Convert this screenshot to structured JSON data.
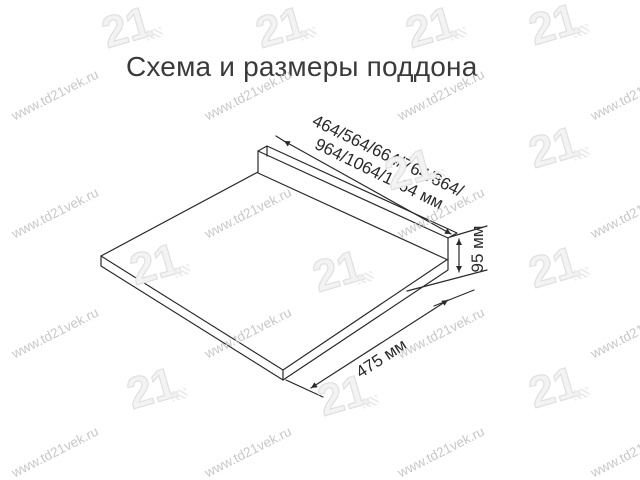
{
  "title": "Схема и размеры поддона",
  "dimensions": {
    "width": {
      "line1": "464/564/664/764/864/",
      "line2": "964/1064/1164 мм"
    },
    "height": "95 мм",
    "depth": "475 мм"
  },
  "watermark": {
    "text": "www.td21vek.ru",
    "logo_text": "21"
  },
  "colors": {
    "line": "#2a2a2a",
    "title_text": "#3a3a3a",
    "watermark_text": "#c8c8c8",
    "watermark_logo": "#e0e0e0",
    "background": "#ffffff"
  }
}
